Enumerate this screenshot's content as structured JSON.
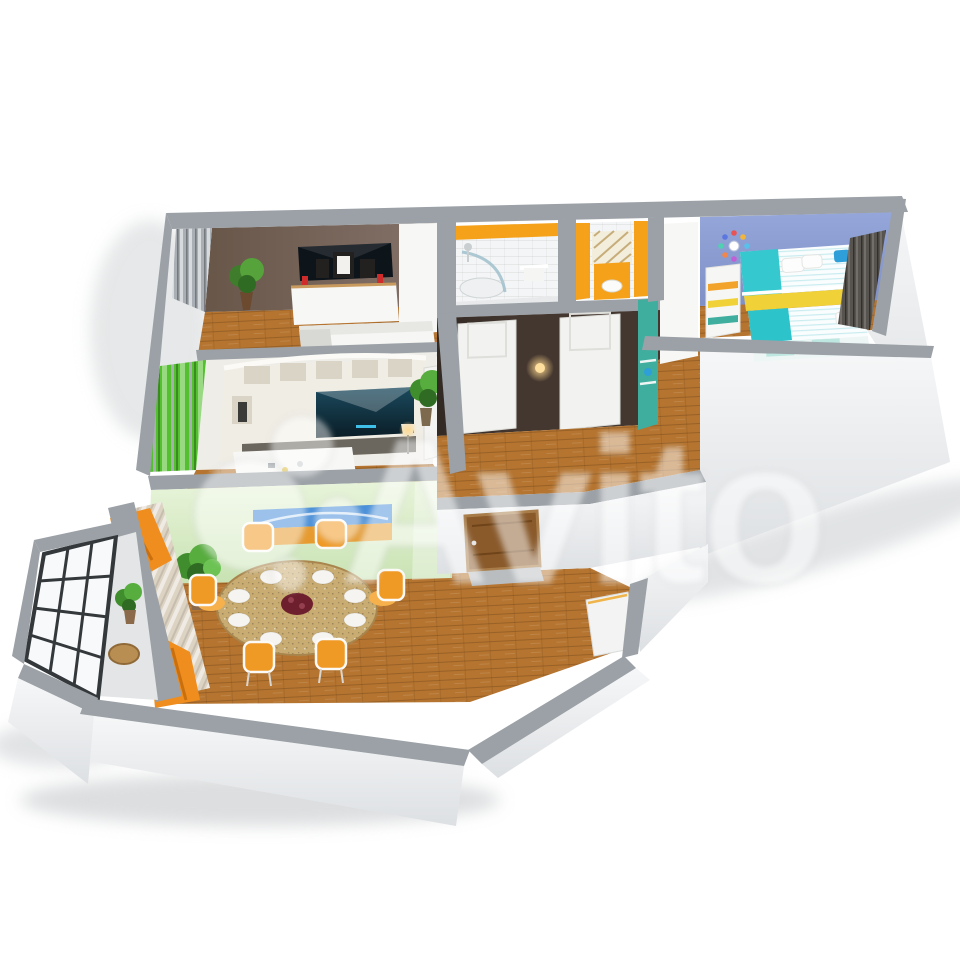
{
  "image": {
    "kind": "3d-floorplan-render",
    "background": "#ffffff"
  },
  "watermark": {
    "text": "Avito",
    "opacity": 0.55
  },
  "colors": {
    "watermark": "#ffffff",
    "wallTop": "#9ba1a6",
    "wallFace": "#f3f4f6",
    "wood": "#b5742f",
    "bedroomWall": "#77655c",
    "livingWall": "#efede8",
    "unitCream": "#f0ede4",
    "unitBase": "#6b675f",
    "diningWall": "#dff0cc",
    "green": "#53c02f",
    "orange": "#ef8d1e",
    "chairOrange": "#f09a26",
    "accentOrange": "#f5a119",
    "hallBrown": "#443730",
    "kidsWall": "#8d9ed3",
    "teal": "#3fae9e",
    "turquoise": "#36c8cf",
    "yellow": "#f1d138",
    "blue": "#2e9fd8",
    "doorWood": "#8a5a2b",
    "tvDark": "#0d141a",
    "paintingSky": "#4a90d9",
    "paintingField": "#e79b2f",
    "white": "#f7f7f5"
  },
  "scene": {
    "rooms": [
      {
        "id": "bedroom",
        "wall": "bedroomWall",
        "items": [
          "wall-tv",
          "dresser",
          "photo-frames",
          "plant",
          "double-bed",
          "grey-blinds",
          "wardrobe"
        ]
      },
      {
        "id": "living-room",
        "wall": "livingWall",
        "items": [
          "shelving-unit",
          "tv",
          "coffee-table",
          "green-curtains",
          "open-door",
          "stool",
          "floor-lamp"
        ]
      },
      {
        "id": "dining-room",
        "wall": "diningWall",
        "items": [
          "oval-table",
          "orange-chairs",
          "plates",
          "red-centerpiece",
          "landscape-painting",
          "plant",
          "orange-curtains",
          "counter"
        ]
      },
      {
        "id": "balcony",
        "items": [
          "glazed-window",
          "plant",
          "round-table"
        ]
      },
      {
        "id": "bathroom",
        "items": [
          "shower",
          "towel-rail",
          "orange-band"
        ]
      },
      {
        "id": "wc",
        "items": [
          "toilet-unit",
          "lattice-shelf",
          "orange-stripes"
        ]
      },
      {
        "id": "hallway",
        "wall": "hallBrown",
        "items": [
          "bathroom-door",
          "wc-door",
          "wall-lamp",
          "wardrobe",
          "teal-cabinet",
          "plant",
          "entrance-door"
        ]
      },
      {
        "id": "kids-room",
        "wall": "kidsWall",
        "items": [
          "bunk-bed",
          "bed-stairs",
          "wall-clock",
          "dark-blinds"
        ]
      }
    ],
    "counts": {
      "dining_chairs": 6,
      "dining_plates": 8,
      "hall_doors": 2
    }
  }
}
